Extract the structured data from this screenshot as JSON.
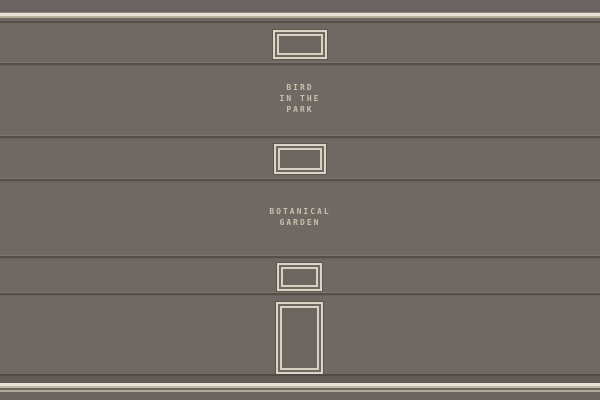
{
  "scene": {
    "name": "pixel wall with framed signs",
    "wall_color": "#6f6863",
    "cornice_stripe_color": "#e8e2d4",
    "cornice_beige_color": "#b7ae9e",
    "seam_color": "#554f4a",
    "frame_border_color": "#dcd5c5",
    "baseboard_stripe_color": "#e8e2d4",
    "text_color": "#c9c1ad"
  },
  "signs": [
    {
      "id": "bird-in-the-park",
      "line1": "BIRD",
      "line2": "IN THE",
      "line3": "PARK"
    },
    {
      "id": "botanical-garden",
      "line1": "BOTANICAL",
      "line2": "GARDEN"
    }
  ]
}
